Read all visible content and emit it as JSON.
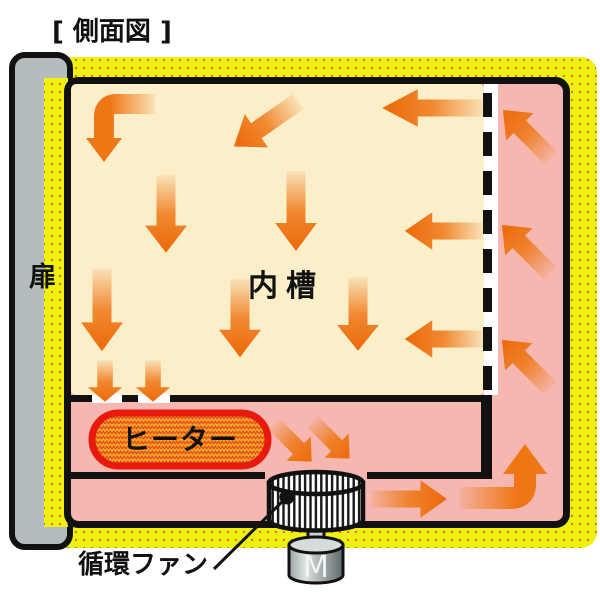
{
  "title": "[ 側面図 ]",
  "labels": {
    "door": "扉",
    "inner_chamber": "内槽",
    "heater": "ヒーター",
    "circulation_fan": "循環ファン",
    "motor": "M"
  },
  "colors": {
    "insulation_yellow": "#edf010",
    "insulation_dots_orange": "#e06818",
    "air_duct_pink": "#f5b7af",
    "inner_chamber_cream": "#fbeec9",
    "airflow_arrow_orange": "#ee7715",
    "heater_fill_orange": "#f4a02a",
    "heater_border_red": "#e81a0e",
    "door_gray": "#b5bcbe",
    "outline_black": "#111111"
  },
  "airflow": {
    "inner_chamber_directions": [
      "curve-left-then-down",
      "diagonal-down-left",
      "left",
      "down",
      "down",
      "down",
      "down",
      "down",
      "left",
      "left",
      "down-small",
      "down-small"
    ],
    "right_duct_directions": [
      "up-left",
      "up-left",
      "up-left",
      "curve-right-then-up"
    ],
    "bottom_duct_directions": [
      "diagonal-down-right",
      "diagonal-down-right",
      "right"
    ]
  }
}
